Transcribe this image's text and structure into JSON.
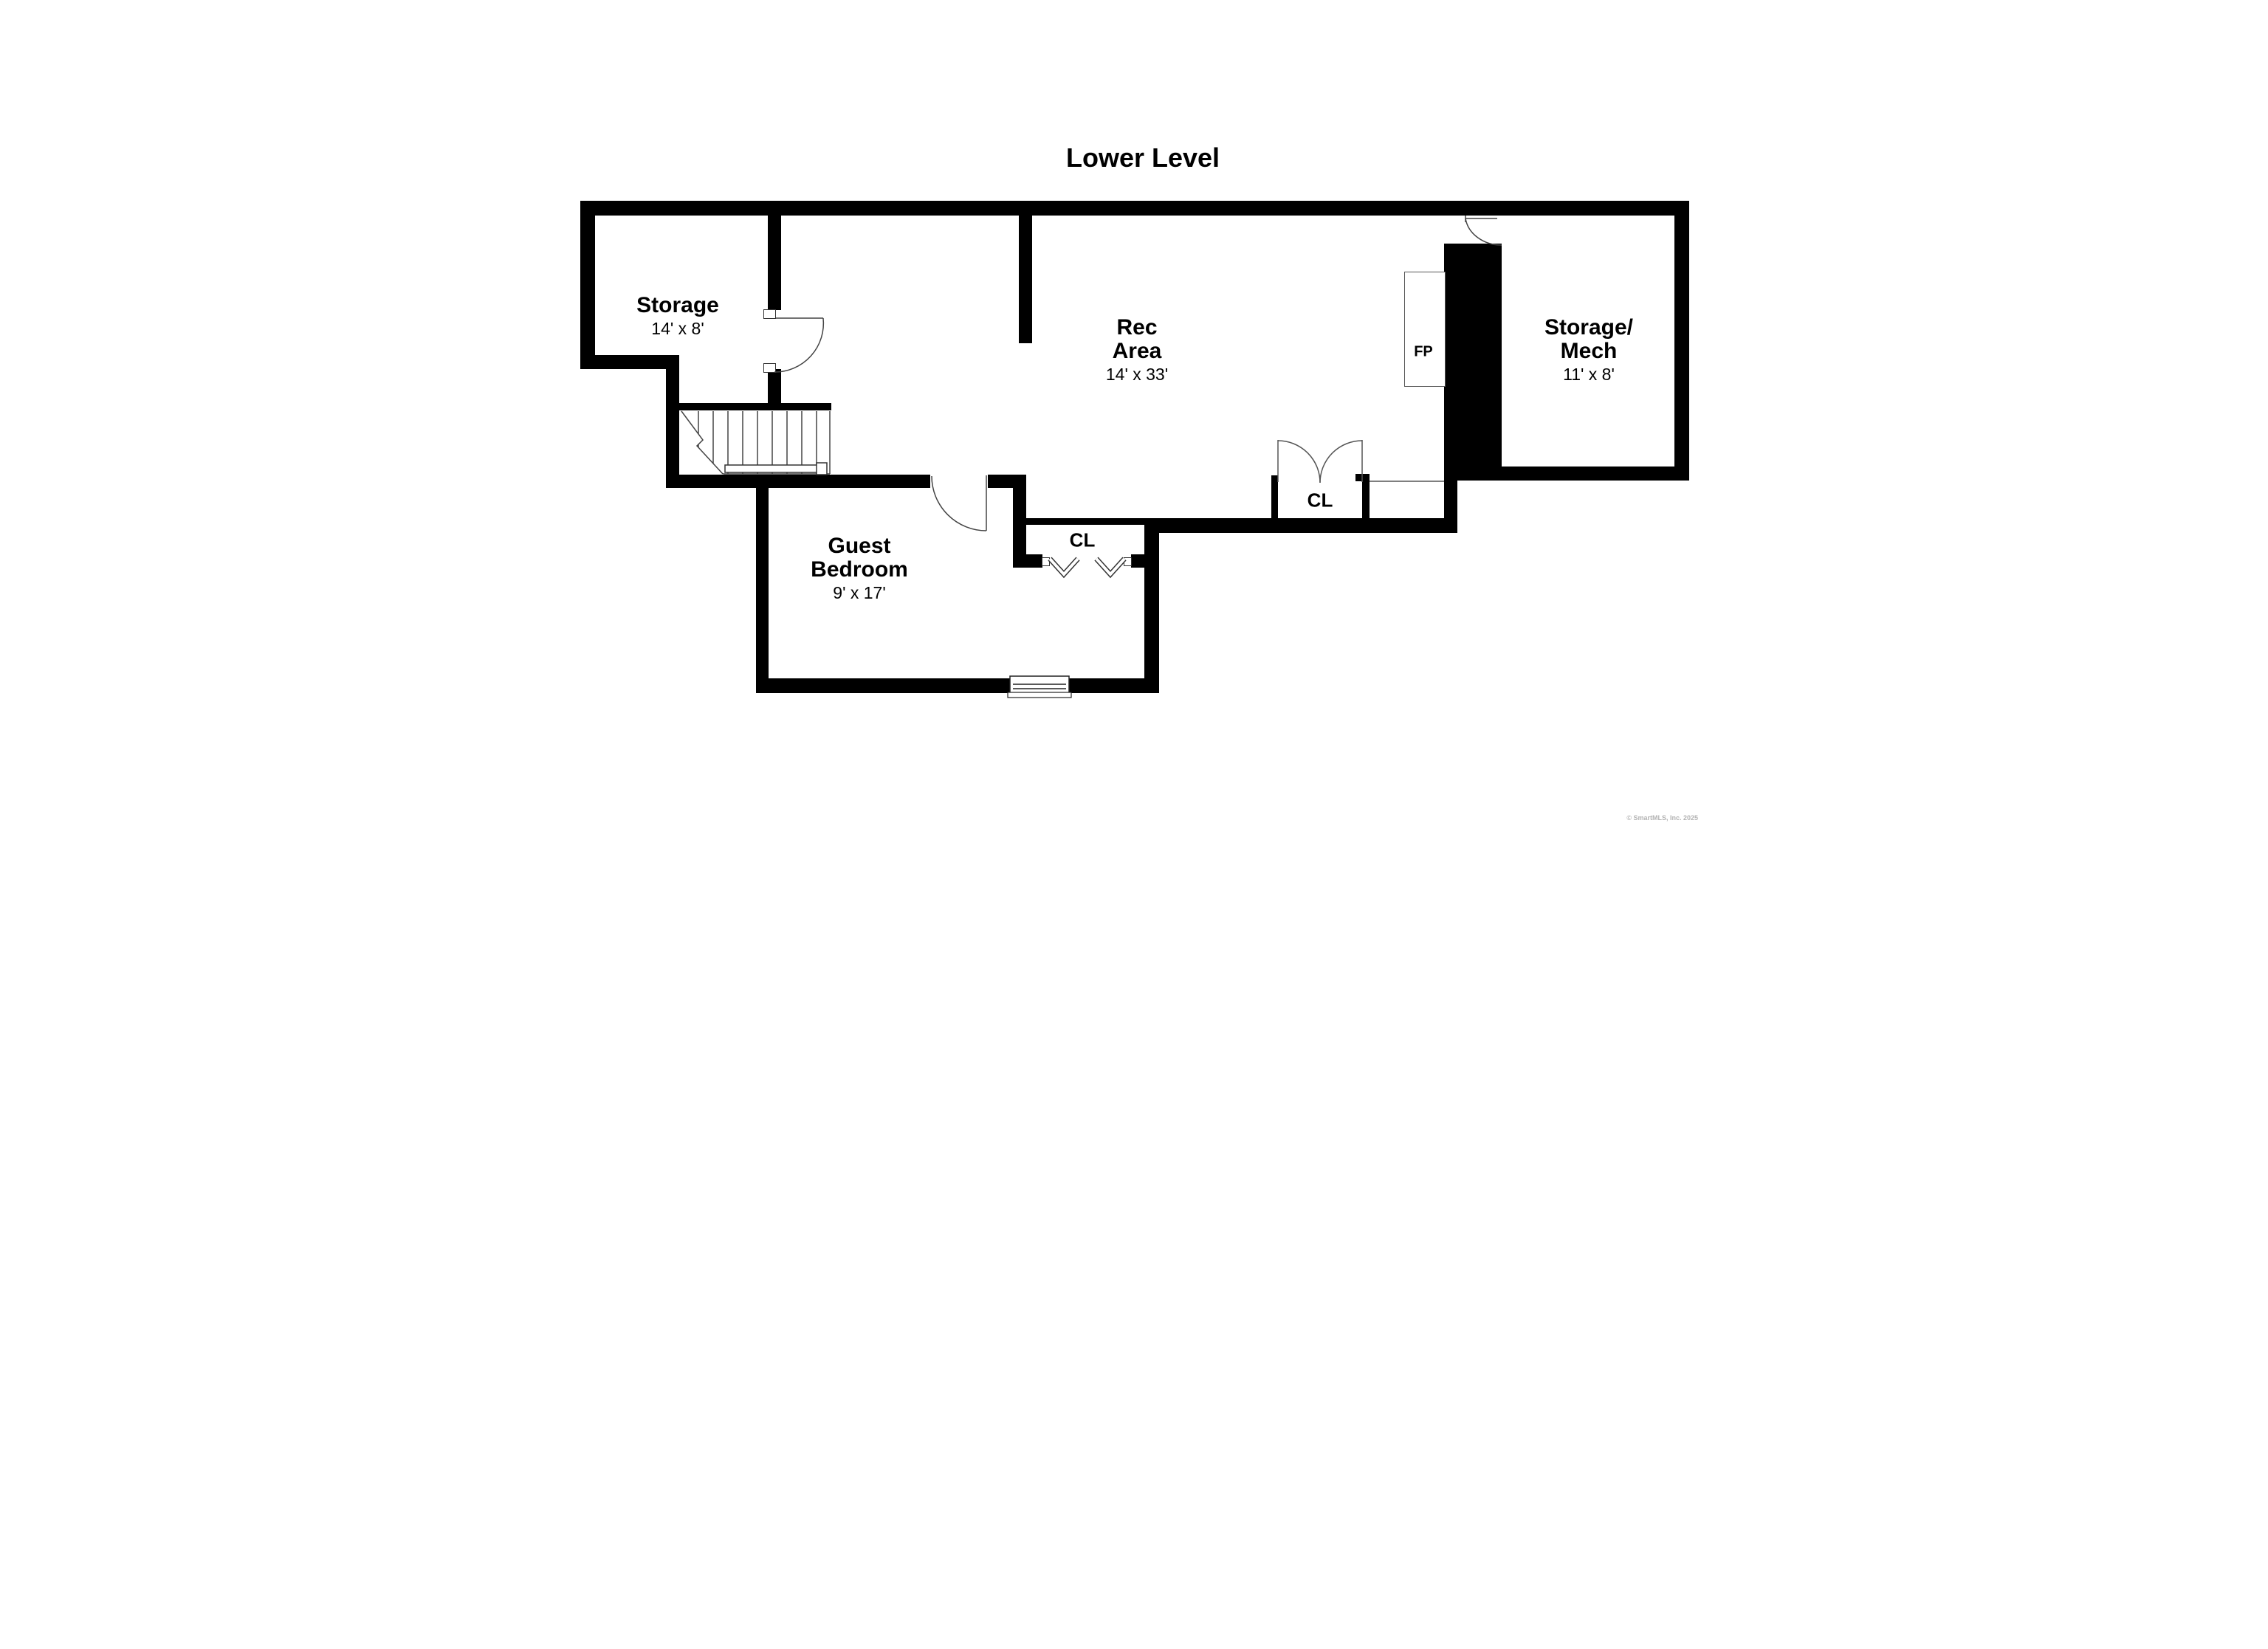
{
  "title": "Lower Level",
  "rooms": {
    "storage": {
      "name": "Storage",
      "dims": "14' x 8'"
    },
    "rec_area": {
      "line1": "Rec",
      "line2": "Area",
      "dims": "14' x 33'"
    },
    "storage_mech": {
      "line1": "Storage/",
      "line2": "Mech",
      "dims": "11' x 8'"
    },
    "guest_bedroom": {
      "line1": "Guest",
      "line2": "Bedroom",
      "dims": "9' x 17'"
    },
    "closet_right": {
      "label": "CL"
    },
    "closet_bedroom": {
      "label": "CL"
    },
    "fireplace": {
      "label": "FP"
    }
  },
  "watermark": "© SmartMLS, Inc. 2025"
}
